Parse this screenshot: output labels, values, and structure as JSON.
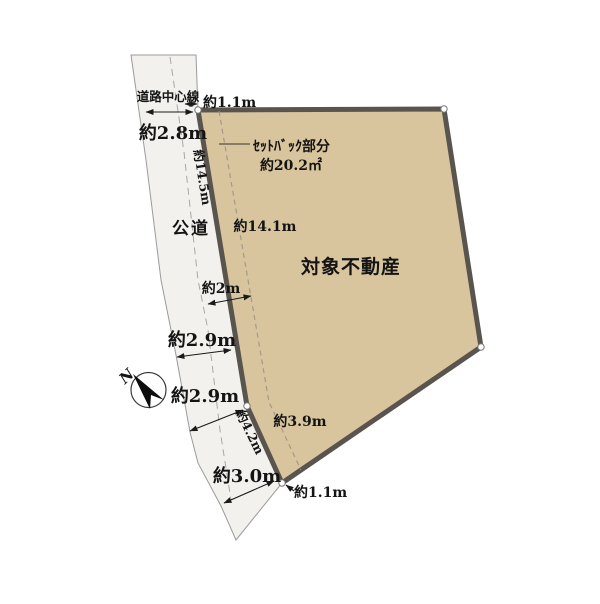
{
  "diagram": {
    "parcel_label": "対象不動産",
    "road_label": "公道",
    "road_center_line_label": "道路中心線",
    "setback": {
      "label": "ｾｯﾄﾊﾞｯｸ部分",
      "area": "約20.2㎡"
    },
    "compass": {
      "north_label": "N"
    },
    "dims": {
      "offset_top": "約1.1m",
      "road_width_top": "約2.8m",
      "parcel_edge_upper": "約14.5m",
      "setback_length_upper": "約14.1m",
      "setback_width": "約2m",
      "road_width_mid1": "約2.9m",
      "road_width_mid2": "約2.9m",
      "parcel_edge_lower": "約4.2m",
      "road_width_bottom": "約3.0m",
      "setback_length_lower": "約3.9m",
      "offset_bottom": "約1.1m"
    },
    "colors": {
      "parcel_fill": "#d8c59d",
      "parcel_border": "#59544e",
      "road_fill": "#f2f1ee",
      "line_gray": "#9b9b9b",
      "text": "#141414"
    }
  }
}
